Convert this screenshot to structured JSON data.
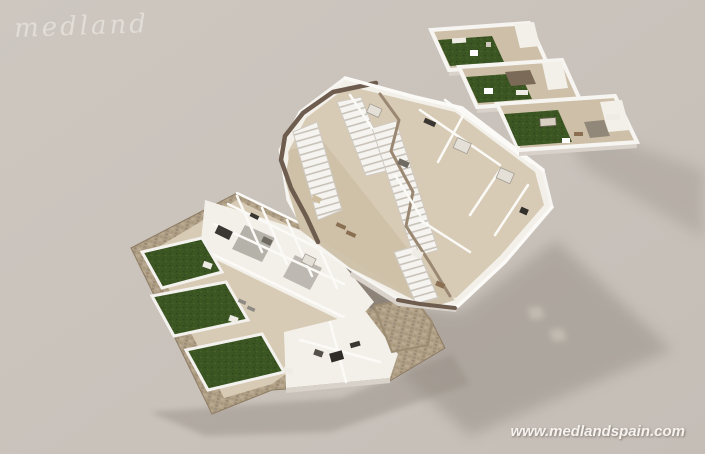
{
  "branding": {
    "logo_text": "medland",
    "watermark_text": "www.medlandspain.com"
  },
  "scene": {
    "type": "3d-isometric-floor-plan-render",
    "levels": [
      {
        "id": "ground-floor-level",
        "garden_plots": 3,
        "stone_perimeter_wall": true,
        "paved_court": true
      },
      {
        "id": "first-floor-level",
        "staircases": 4,
        "terraces": 2
      },
      {
        "id": "roof-solarium-level",
        "terraces": 3,
        "turf_patches": 3,
        "pergola": 1
      }
    ]
  },
  "colors": {
    "bg_top": "#cdc7c0",
    "bg_mid": "#c9c2bb",
    "bg_bottom": "#c5beb7",
    "logo": "#e9e5df",
    "watermark": "#f6f3ef",
    "wall": "#f3f0ea",
    "wall_bright": "#fbfaf7",
    "wall_shade": "#d8d2ca",
    "floor": "#d8cbb5",
    "terrace": "#cec0a8",
    "grass": "#3c5623",
    "grass_dark": "#2d4318",
    "stone": "#b1a189",
    "stone_dark": "#8d7c64",
    "eave": "#6e5d4f",
    "walkway": "#9b8873",
    "cut": "#8b8278",
    "shadow": "#958d84",
    "furn_dark": "#3a3631",
    "furn_brown": "#8a6f52",
    "furn_light": "#efece6",
    "glow": "#c6bfb6"
  }
}
